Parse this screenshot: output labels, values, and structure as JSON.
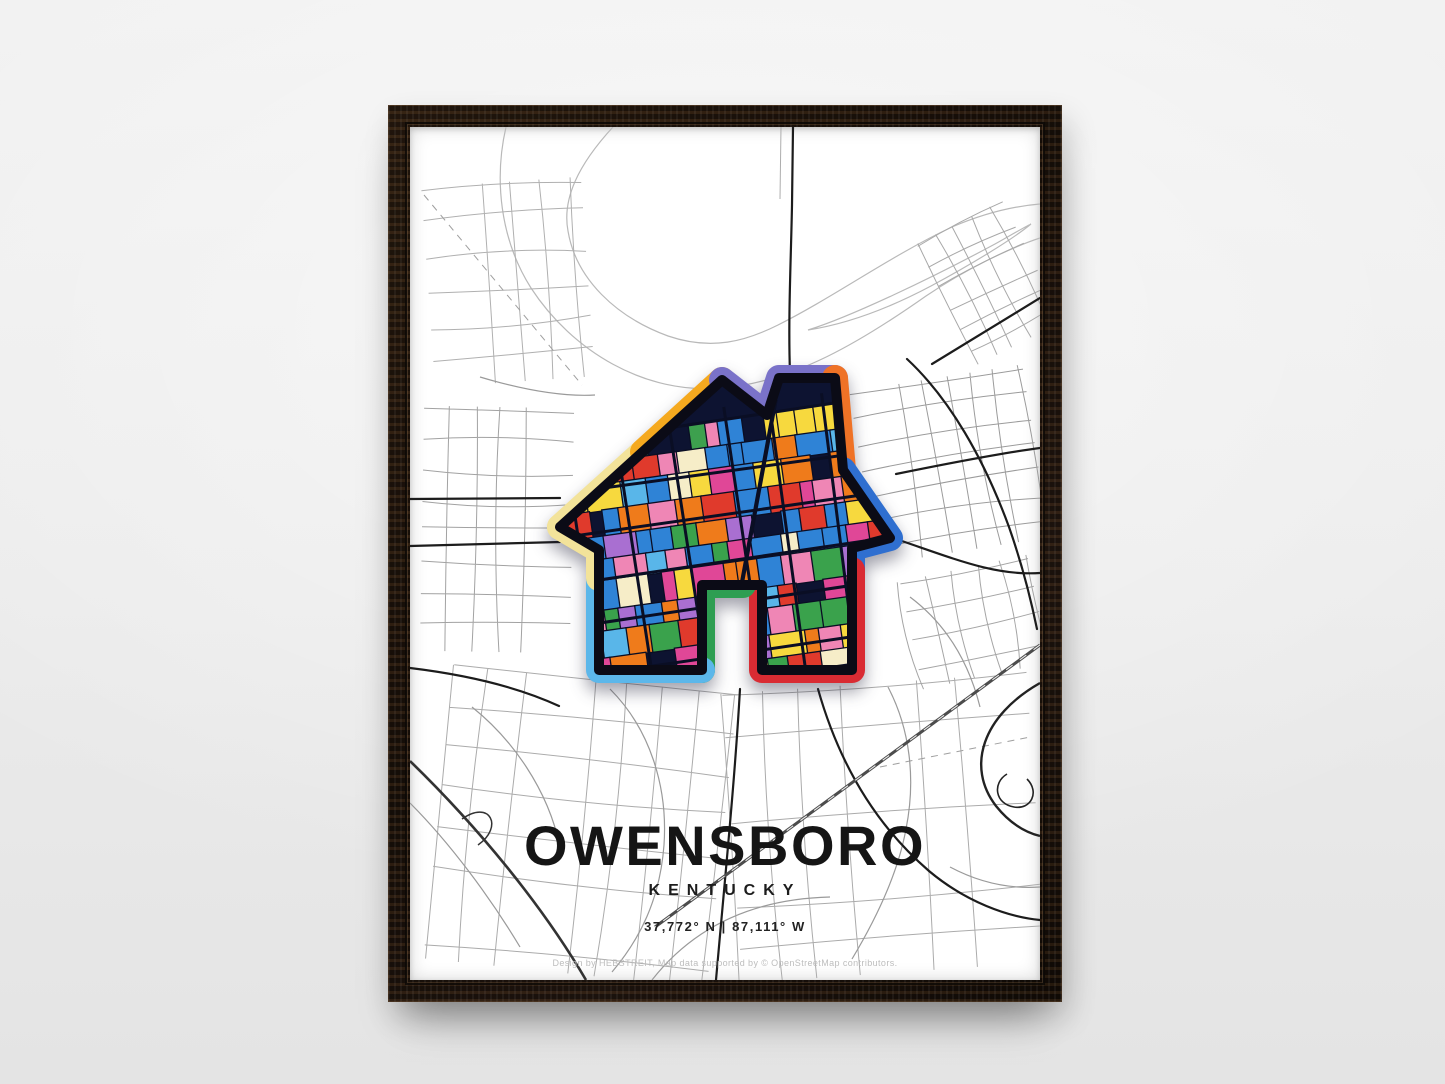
{
  "scene": {
    "wall_color": "#ededed",
    "frame_color": "#1d130b"
  },
  "poster": {
    "title": "OWENSBORO",
    "subtitle": "KENTUCKY",
    "coordinates": "37,772° N | 87,111° W",
    "attribution": "Design by HEBSTREIT, Map data supported by © OpenStreetMap contributors.",
    "map": {
      "street_color": "#adadad",
      "main_road_color": "#1c1c1c",
      "water_outline_color": "#b9b9b9"
    },
    "house": {
      "background": "#0d1331",
      "street_color": "#0a0e24",
      "outline_color": "#0b0b16",
      "palette": [
        "#e03a2c",
        "#2f83d6",
        "#ef7b1b",
        "#f7d93e",
        "#e04797",
        "#2f83d6",
        "#e03a2c",
        "#59b6e9",
        "#ef7b1b",
        "#a96fd1",
        "#f7d93e",
        "#e04797",
        "#2f83d6",
        "#e03a2c",
        "#ef7b1b",
        "#ef86b5",
        "#f6edc8",
        "#3aa24c"
      ],
      "accent_green": "#3da04e",
      "accent_yellow": "#f7d93e",
      "ring": [
        {
          "name": "left-roof-lower",
          "color": "#f3e39a"
        },
        {
          "name": "left-roof-upper",
          "color": "#f5a91f"
        },
        {
          "name": "peak-valley-chimney-top",
          "color": "#7a72c9"
        },
        {
          "name": "chimney-right",
          "color": "#ef7226"
        },
        {
          "name": "right-roof-eave",
          "color": "#2f6fd0"
        },
        {
          "name": "right-wall-bottom",
          "color": "#d92b33"
        },
        {
          "name": "door",
          "color": "#2e9e52"
        },
        {
          "name": "bottom-left-wall",
          "color": "#5cb7ea"
        },
        {
          "name": "left-wall-upper",
          "color": "#f3e39a"
        }
      ]
    }
  }
}
